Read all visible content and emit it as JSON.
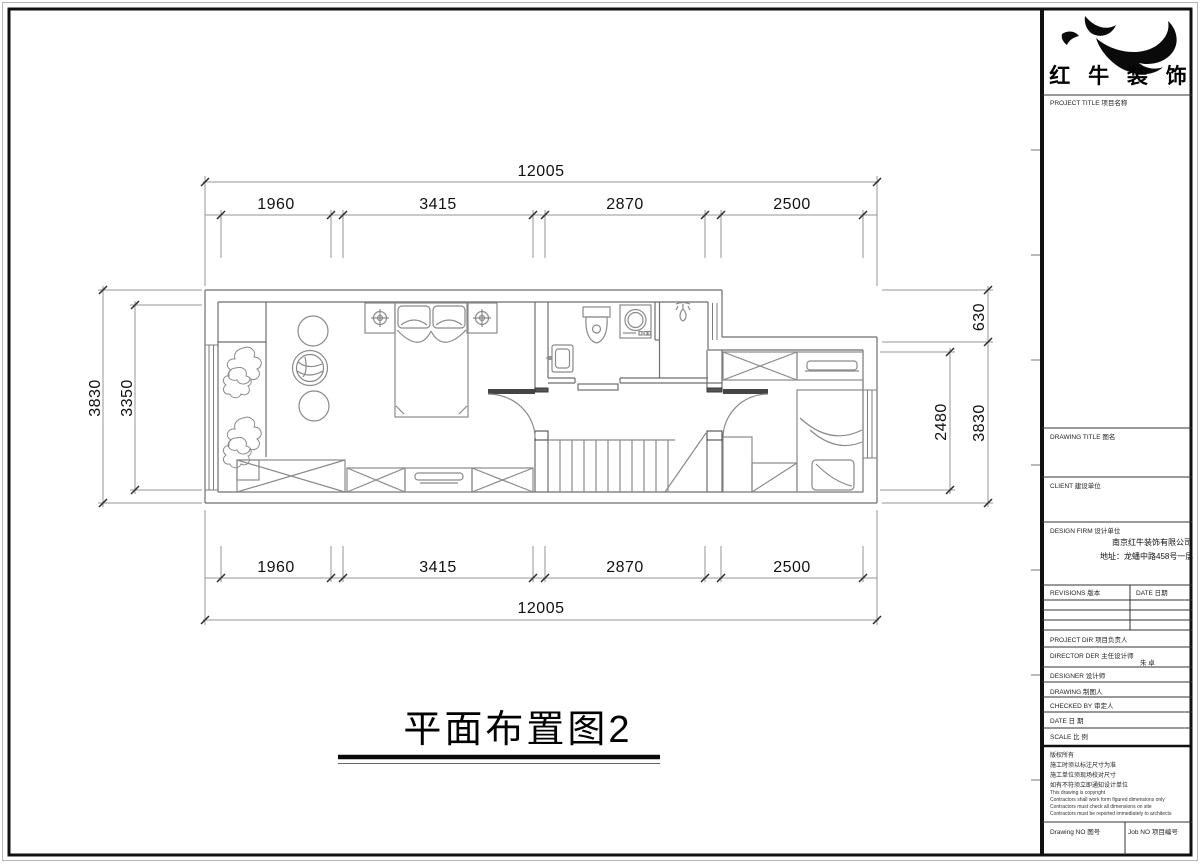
{
  "company": {
    "logo_name": "红 牛 装 饰",
    "firm_name": "南京红牛装饰有限公司",
    "address": "地址：龙蟠中路458号一层"
  },
  "drawing": {
    "title": "平面布置图2"
  },
  "dims": {
    "total": "12005",
    "segments": [
      "1960",
      "3415",
      "2870",
      "2500"
    ],
    "left_outer": "3830",
    "left_inner": "3350",
    "right_upper": "630",
    "right_outer": "3830",
    "right_inner": "2480"
  },
  "title_block": {
    "project_title": "PROJECT TITLE 项目名称",
    "drawing_title": "DRAWING TITLE 图名",
    "client": "CLIENT 建设单位",
    "design_firm": "DESIGN FIRM 设计单位",
    "revisions": "REVISIONS 版本",
    "date_header": "DATE 日期",
    "project_dir": "PROJECT DIR 项目负责人",
    "director": "DIRECTOR DER 主任设计师",
    "director_name": "朱 卓",
    "designer": "DESIGNER 设计师",
    "drawing_by": "DRAWING 制图人",
    "checked_by": "CHECKED BY 审定人",
    "date": "DATE 日 期",
    "scale": "SCALE 比 例",
    "copyright_cn": [
      "版权所有",
      "施工时须以标注尺寸为准",
      "施工单位须现场校对尺寸",
      "如有不符须立即通知设计单位"
    ],
    "copyright_en": [
      "This drawing is copyright",
      "Contractors shall work form figured dimensions only",
      "Contractors must check all dimensions on site",
      "Contractors must be reported immediately to architects"
    ],
    "drawing_no": "Drawing NO 图号",
    "job_no": "Job NO 项目编号"
  }
}
